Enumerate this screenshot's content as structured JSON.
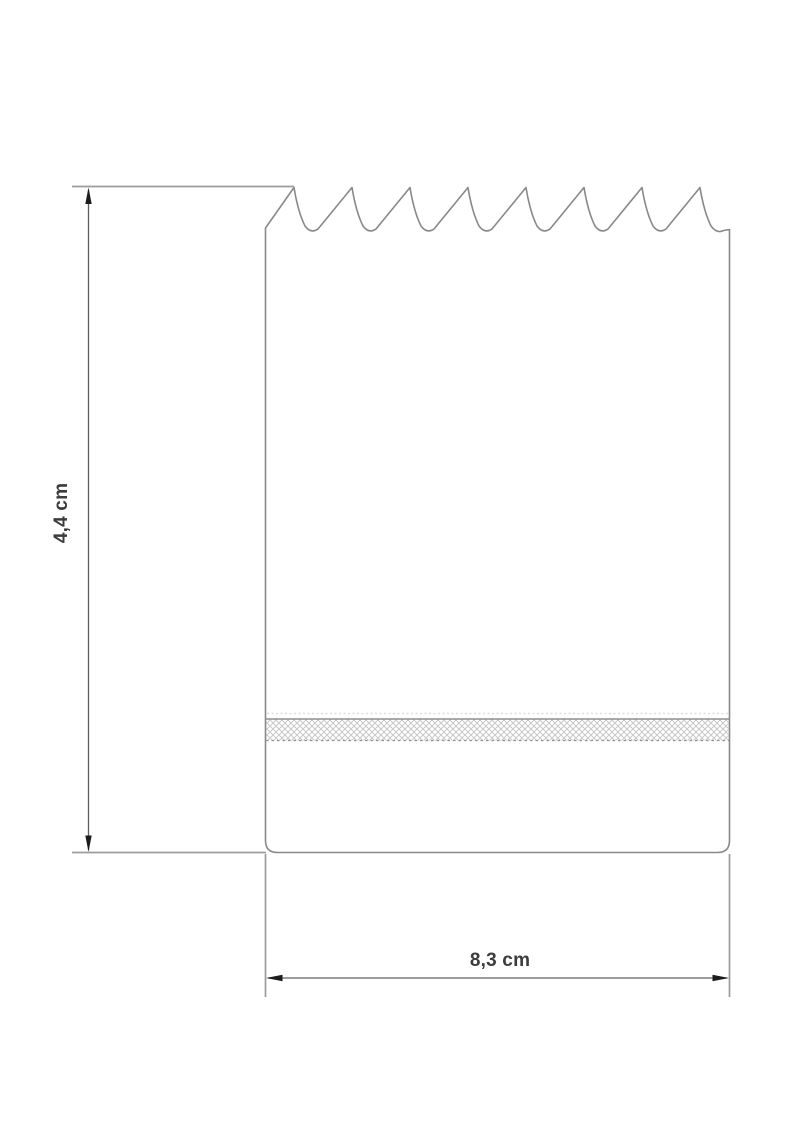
{
  "diagram": {
    "type": "technical-dimension-drawing",
    "subject": "tear-off pad with serrated top edge and adhesive glue strip",
    "teeth_count": 8,
    "dimensions": {
      "height_label": "4,4 cm",
      "width_label": "8,3 cm"
    },
    "colors": {
      "background": "#ffffff",
      "outline": "#898989",
      "extension_line": "#9b9b9b",
      "dimension_line": "#5f5f5f",
      "arrow": "#1c1c1c",
      "label_text": "#3c3c3c",
      "strip_hatch": "#c9c9c9",
      "strip_border": "#8f8f8f"
    }
  }
}
